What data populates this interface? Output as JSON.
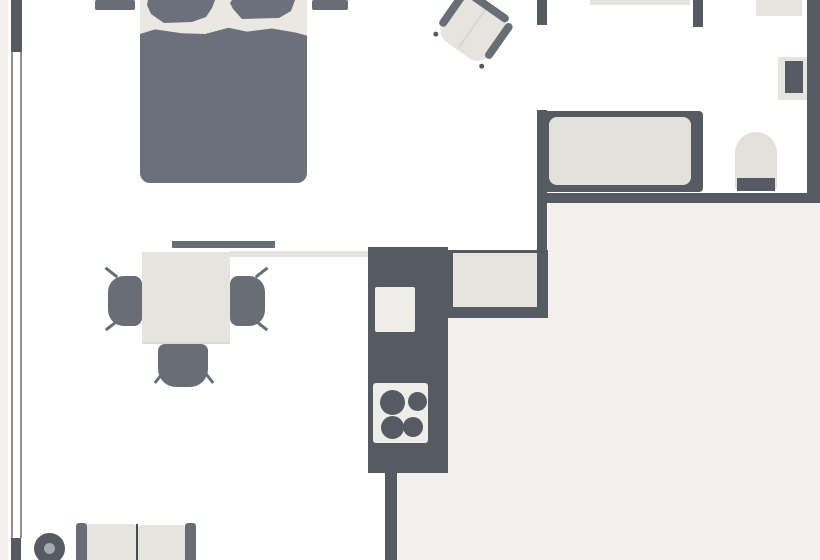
{
  "canvas": {
    "w": 820,
    "h": 560,
    "bg": "#ffffff"
  },
  "palette": {
    "wall": "#565a62",
    "dark": "#686d76",
    "bedding": "#6b707a",
    "cream": "#e6e4df",
    "mattress": "#eae8e2",
    "floor": "#f1f0ec",
    "appliance": "#eeedea",
    "fixture": "#e2e1dc",
    "line": "#8f9197",
    "plantCenter": "#a6a9ad",
    "divider": "#474b52",
    "shadow": "#dcdad4",
    "seam": "#d8d6d2"
  },
  "shapes": [
    {
      "name": "exterior-strip",
      "type": "rect",
      "x": 0,
      "y": 0,
      "w": 8,
      "h": 560,
      "fill": "floor"
    },
    {
      "name": "hall-floor-upper",
      "type": "rect",
      "x": 548,
      "y": 203,
      "w": 272,
      "h": 357,
      "fill": "floor"
    },
    {
      "name": "hall-floor-mid",
      "type": "rect",
      "x": 448,
      "y": 318,
      "w": 100,
      "h": 242,
      "fill": "floor"
    },
    {
      "name": "hall-floor-lower",
      "type": "rect",
      "x": 397,
      "y": 473,
      "w": 51,
      "h": 87,
      "fill": "floor"
    },
    {
      "name": "window-outer-line",
      "type": "rect",
      "x": 11,
      "y": 52,
      "w": 2,
      "h": 486,
      "fill": "line"
    },
    {
      "name": "window-inner-line",
      "type": "rect",
      "x": 19.5,
      "y": 52,
      "w": 2,
      "h": 486,
      "fill": "line"
    },
    {
      "name": "left-wall-upper",
      "type": "rect",
      "x": 11,
      "y": 0,
      "w": 11,
      "h": 52,
      "fill": "wall"
    },
    {
      "name": "left-wall-lower",
      "type": "rect",
      "x": 11,
      "y": 538,
      "w": 10,
      "h": 22,
      "fill": "wall"
    },
    {
      "name": "bathroom-left-wall-stub",
      "type": "rect",
      "x": 537,
      "y": 0,
      "w": 10,
      "h": 25,
      "fill": "wall"
    },
    {
      "name": "bathroom-left-wall",
      "type": "rect",
      "x": 537,
      "y": 110,
      "w": 10,
      "h": 208,
      "fill": "wall"
    },
    {
      "name": "bathroom-partition-wall",
      "type": "rect",
      "x": 693,
      "y": 0,
      "w": 10,
      "h": 27,
      "fill": "wall"
    },
    {
      "name": "bathroom-right-wall",
      "type": "rect",
      "x": 807,
      "y": 0,
      "w": 13,
      "h": 203,
      "fill": "wall"
    },
    {
      "name": "bathroom-bottom-wall",
      "type": "rect",
      "x": 537,
      "y": 193,
      "w": 283,
      "h": 10,
      "fill": "wall"
    },
    {
      "name": "kitchen-divider-wall",
      "type": "rect",
      "x": 385,
      "y": 473,
      "w": 12,
      "h": 87,
      "fill": "wall"
    },
    {
      "name": "vanity-counter",
      "type": "rect",
      "x": 590,
      "y": 0,
      "w": 100,
      "h": 5,
      "fill": "cream"
    },
    {
      "name": "wall-shelf",
      "type": "rect",
      "x": 756,
      "y": 0,
      "w": 46,
      "h": 16,
      "fill": "cream"
    },
    {
      "name": "radiator-panel",
      "type": "rect",
      "x": 778,
      "y": 57,
      "w": 29,
      "h": 43,
      "fill": "cream"
    },
    {
      "name": "radiator",
      "type": "rect",
      "x": 785,
      "y": 61,
      "w": 18,
      "h": 32,
      "fill": "wall"
    },
    {
      "name": "bathtub",
      "type": "rect",
      "x": 537,
      "y": 111,
      "w": 166,
      "h": 81,
      "fill": "wall",
      "radius": "4px"
    },
    {
      "name": "bathtub-basin",
      "type": "rect",
      "x": 549,
      "y": 117,
      "w": 142,
      "h": 68,
      "fill": "fixture",
      "radius": "8px"
    },
    {
      "name": "toilet-bowl",
      "type": "rect",
      "x": 735,
      "y": 132,
      "w": 42,
      "h": 58,
      "fill": "fixture",
      "radius": "21px 21px 3px 3px"
    },
    {
      "name": "toilet-tank",
      "type": "rect",
      "x": 737,
      "y": 178,
      "w": 38,
      "h": 13,
      "fill": "wall"
    },
    {
      "name": "bed-mattress",
      "type": "rect",
      "x": 140,
      "y": 0,
      "w": 167,
      "h": 62,
      "fill": "mattress"
    },
    {
      "name": "bed-blanket",
      "type": "rect",
      "x": 140,
      "y": 27,
      "w": 167,
      "h": 156,
      "fill": "bedding",
      "radius": "0 0 10px 10px",
      "clip": "polygon(0% 4.5%, 9% 1.5%, 25% 4%, 39% 4.5%, 53% 0.5%, 64% 3%, 79% 1%, 93% 3.5%, 100% 5.5%, 100% 100%, 0% 100%)"
    },
    {
      "name": "bed-pillow-left",
      "type": "rect",
      "x": 146,
      "y": 0,
      "w": 71,
      "h": 23,
      "fill": "bedding",
      "clip": "polygon(2px 0px, 69px 0px, 66px 8px, 60px 17px, 46px 22px, 18px 23px, 5px 14px, 1px 5px)"
    },
    {
      "name": "bed-pillow-right",
      "type": "rect",
      "x": 229,
      "y": 0,
      "w": 68,
      "h": 20,
      "fill": "bedding",
      "clip": "polygon(3px 0px, 66px 0px, 62px 11px, 50px 18px, 13px 19px, 4px 9px, 1px 3px)"
    },
    {
      "name": "nightstand-left",
      "type": "rect",
      "x": 95,
      "y": 0,
      "w": 40,
      "h": 10,
      "fill": "dark",
      "radius": "2px"
    },
    {
      "name": "nightstand-right",
      "type": "rect",
      "x": 312,
      "y": 0,
      "w": 36,
      "h": 10,
      "fill": "dark",
      "radius": "2px"
    },
    {
      "name": "armchair",
      "type": "group",
      "x": 443,
      "y": 1,
      "w": 60,
      "h": 56,
      "rotate": 35,
      "children": [
        {
          "name": "armchair-seat",
          "type": "rect",
          "x": 2,
          "y": 0,
          "w": 56,
          "h": 54,
          "fill": "cream",
          "radius": "14px"
        },
        {
          "name": "armchair-seam",
          "type": "rect",
          "x": 28,
          "y": 3,
          "w": 1.5,
          "h": 48,
          "fill": "seam"
        },
        {
          "name": "armchair-back-bar",
          "type": "rect",
          "x": 6,
          "y": -3,
          "w": 48,
          "h": 8,
          "fill": "dark",
          "radius": "4px"
        },
        {
          "name": "armchair-armrest-left",
          "type": "rect",
          "x": -2,
          "y": 2,
          "w": 8,
          "h": 42,
          "fill": "dark",
          "radius": "4px"
        },
        {
          "name": "armchair-armrest-right",
          "type": "rect",
          "x": 54,
          "y": 2,
          "w": 8,
          "h": 42,
          "fill": "dark",
          "radius": "4px"
        },
        {
          "name": "armchair-foot-left",
          "type": "circle",
          "cx": 2,
          "cy": 53,
          "r": 2.5,
          "fill": "wall"
        },
        {
          "name": "armchair-foot-right",
          "type": "circle",
          "cx": 58,
          "cy": 53,
          "r": 2.5,
          "fill": "wall"
        }
      ]
    },
    {
      "name": "sideboard-shelf",
      "type": "rect",
      "x": 172,
      "y": 240.5,
      "w": 103,
      "h": 7.5,
      "fill": "dark"
    },
    {
      "name": "counter-strip",
      "type": "rect",
      "x": 230,
      "y": 250.5,
      "w": 138,
      "h": 6,
      "fill": "cream"
    },
    {
      "name": "dining-chair-left-leg-top",
      "type": "rect",
      "x": 104,
      "y": 271,
      "w": 15,
      "h": 2.5,
      "fill": "dark",
      "rotate": 38
    },
    {
      "name": "dining-chair-left-leg-bottom",
      "type": "rect",
      "x": 104,
      "y": 323.5,
      "w": 15,
      "h": 2.5,
      "fill": "dark",
      "rotate": -38
    },
    {
      "name": "dining-chair-left",
      "type": "rect",
      "x": 108,
      "y": 276,
      "w": 34,
      "h": 50,
      "fill": "dark",
      "radius": "16px 8px 8px 16px"
    },
    {
      "name": "dining-chair-right-leg-top",
      "type": "rect",
      "x": 254,
      "y": 271,
      "w": 15,
      "h": 2.5,
      "fill": "dark",
      "rotate": -38
    },
    {
      "name": "dining-chair-right-leg-bottom",
      "type": "rect",
      "x": 254,
      "y": 323.5,
      "w": 15,
      "h": 2.5,
      "fill": "dark",
      "rotate": 38
    },
    {
      "name": "dining-chair-right",
      "type": "rect",
      "x": 230,
      "y": 276,
      "w": 35,
      "h": 50,
      "fill": "dark",
      "radius": "8px 16px 16px 8px"
    },
    {
      "name": "dining-chair-bottom-leg-left",
      "type": "rect",
      "x": 152,
      "y": 376,
      "w": 14,
      "h": 2.5,
      "fill": "dark",
      "rotate": -52
    },
    {
      "name": "dining-chair-bottom-leg-right",
      "type": "rect",
      "x": 202,
      "y": 376,
      "w": 14,
      "h": 2.5,
      "fill": "dark",
      "rotate": 52
    },
    {
      "name": "dining-chair-bottom",
      "type": "rect",
      "x": 158,
      "y": 344,
      "w": 50,
      "h": 43,
      "fill": "dark",
      "radius": "7px 7px 18px 18px"
    },
    {
      "name": "dining-table",
      "type": "rect",
      "x": 142,
      "y": 251.5,
      "w": 88,
      "h": 90,
      "fill": "cream"
    },
    {
      "name": "dining-table-edge",
      "type": "rect",
      "x": 142,
      "y": 341.5,
      "w": 88,
      "h": 2.5,
      "fill": "shadow"
    },
    {
      "name": "kitchen-unit",
      "type": "rect",
      "x": 368,
      "y": 247,
      "w": 80,
      "h": 226,
      "fill": "wall"
    },
    {
      "name": "kitchen-counter-frame",
      "type": "rect",
      "x": 448,
      "y": 250,
      "w": 100,
      "h": 68,
      "fill": "wall"
    },
    {
      "name": "kitchen-counter",
      "type": "rect",
      "x": 453,
      "y": 253,
      "w": 84,
      "h": 54,
      "fill": "cream"
    },
    {
      "name": "kitchen-sink",
      "type": "rect",
      "x": 375,
      "y": 287,
      "w": 40,
      "h": 45,
      "fill": "appliance",
      "radius": "2px"
    },
    {
      "name": "kitchen-stove",
      "type": "rect",
      "x": 373,
      "y": 383,
      "w": 55,
      "h": 60,
      "fill": "appliance",
      "radius": "3px"
    },
    {
      "name": "stove-burner-top-left",
      "type": "circle",
      "cx": 392,
      "cy": 402,
      "r": 12.5,
      "fill": "wall"
    },
    {
      "name": "stove-burner-top-right",
      "type": "circle",
      "cx": 417,
      "cy": 401,
      "r": 9.5,
      "fill": "wall"
    },
    {
      "name": "stove-burner-bottom-left",
      "type": "circle",
      "cx": 392,
      "cy": 427,
      "r": 11.5,
      "fill": "wall"
    },
    {
      "name": "stove-burner-bottom-right",
      "type": "circle",
      "cx": 413,
      "cy": 427,
      "r": 10,
      "fill": "wall"
    },
    {
      "name": "sofa-armrest-left",
      "type": "rect",
      "x": 76,
      "y": 523,
      "w": 11,
      "h": 37,
      "fill": "dark",
      "radius": "3px 3px 0 0"
    },
    {
      "name": "sofa-cushion-left",
      "type": "rect",
      "x": 87,
      "y": 524,
      "w": 49,
      "h": 36,
      "fill": "cream",
      "radius": "3px 3px 0 0"
    },
    {
      "name": "sofa-cushion-divider",
      "type": "rect",
      "x": 136,
      "y": 524,
      "w": 2,
      "h": 36,
      "fill": "divider"
    },
    {
      "name": "sofa-cushion-right",
      "type": "rect",
      "x": 138,
      "y": 525,
      "w": 47,
      "h": 35,
      "fill": "cream",
      "radius": "3px 3px 0 0"
    },
    {
      "name": "sofa-armrest-right",
      "type": "rect",
      "x": 185,
      "y": 523,
      "w": 11,
      "h": 37,
      "fill": "dark",
      "radius": "3px 3px 0 0"
    },
    {
      "name": "plant-pot",
      "type": "circle",
      "cx": 49,
      "cy": 548,
      "r": 15.5,
      "fill": "wall"
    },
    {
      "name": "plant-center",
      "type": "circle",
      "cx": 49,
      "cy": 548,
      "r": 5.5,
      "fill": "plantCenter"
    }
  ]
}
